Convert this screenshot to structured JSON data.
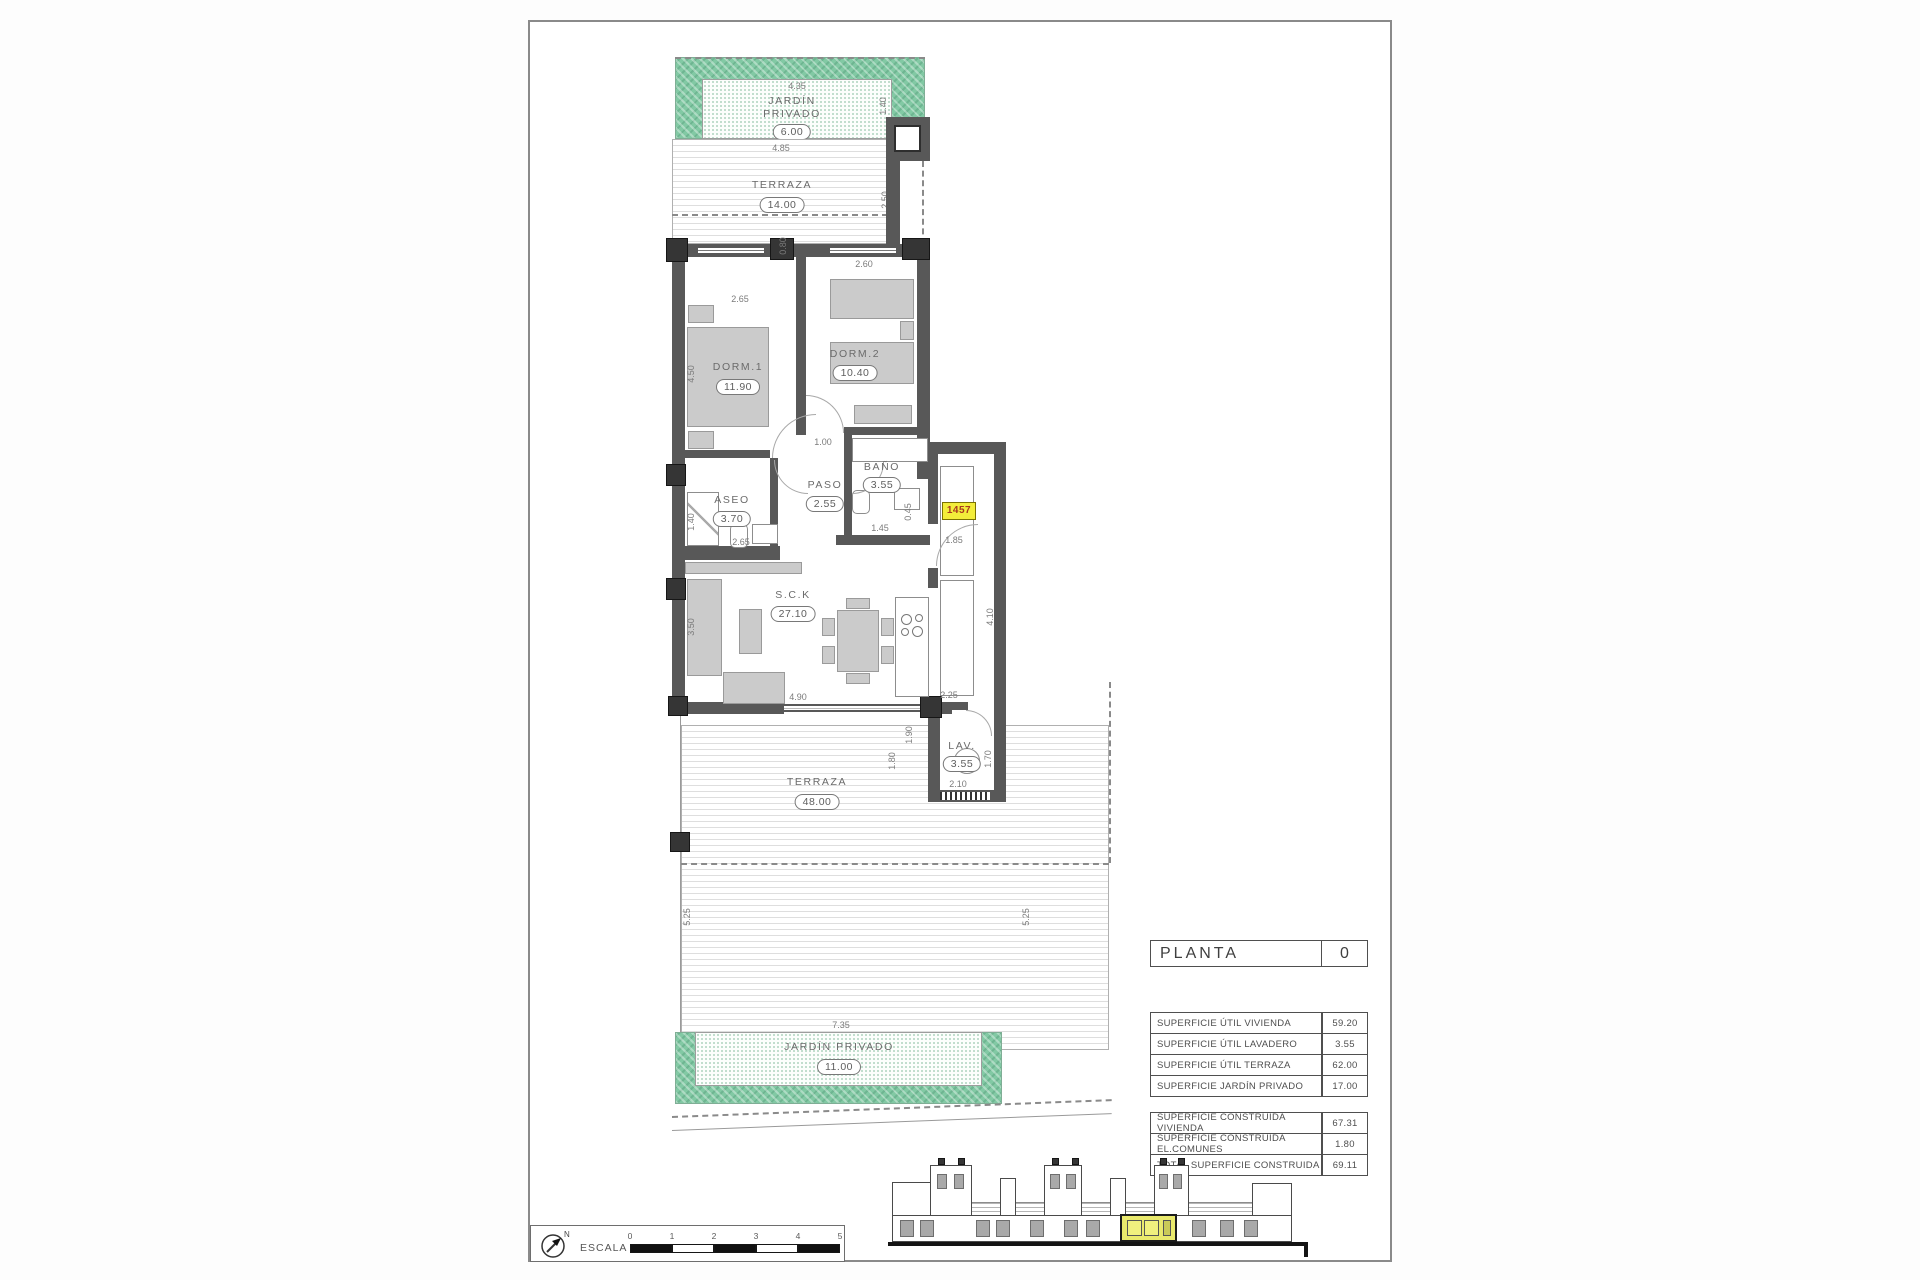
{
  "page": {
    "planta": {
      "label": "PLANTA",
      "value": "0"
    },
    "tables": {
      "util": [
        {
          "label": "SUPERFICIE ÚTIL VIVIENDA",
          "value": "59.20"
        },
        {
          "label": "SUPERFICIE ÚTIL LAVADERO",
          "value": "3.55"
        },
        {
          "label": "SUPERFICIE ÚTIL TERRAZA",
          "value": "62.00"
        },
        {
          "label": "SUPERFICIE JARDÍN PRIVADO",
          "value": "17.00"
        }
      ],
      "construida": [
        {
          "label": "SUPERFICIE CONSTRUIDA VIVIENDA",
          "value": "67.31"
        },
        {
          "label": "SUPERFICIE CONSTRUIDA EL.COMUNES",
          "value": "1.80"
        },
        {
          "label": "TOTAL SUPERFICIE CONSTRUIDA",
          "value": "69.11"
        }
      ]
    },
    "rooms": {
      "jardin_top": {
        "line1": "JARDÍN",
        "line2": "PRIVADO",
        "area": "6.00"
      },
      "terraza_top": {
        "name": "TERRAZA",
        "area": "14.00"
      },
      "dorm1": {
        "name": "DORM.1",
        "area": "11.90"
      },
      "dorm2": {
        "name": "DORM.2",
        "area": "10.40"
      },
      "aseo": {
        "name": "ASEO",
        "area": "3.70"
      },
      "paso": {
        "name": "PASO",
        "area": "2.55"
      },
      "bano": {
        "name": "BAÑO",
        "area": "3.55"
      },
      "sck": {
        "name": "S.C.K",
        "area": "27.10"
      },
      "lav": {
        "name": "LAV.",
        "area": "3.55"
      },
      "terraza_bottom": {
        "name": "TERRAZA",
        "area": "48.00"
      },
      "jardin_bottom": {
        "name": "JARDÍN PRIVADO",
        "area": "11.00"
      }
    },
    "unit_tag": "1457",
    "dims": {
      "d435": "4.35",
      "d140": "1.40",
      "d485": "4.85",
      "d250": "2.50",
      "d080": "0.80",
      "d260": "2.60",
      "d265a": "2.65",
      "d450": "4.50",
      "d100": "1.00",
      "d140b": "1.40",
      "d265b": "2.65",
      "d045": "0.45",
      "d145": "1.45",
      "d185": "1.85",
      "d350": "3.50",
      "d490": "4.90",
      "d410": "4.10",
      "d225": "2.25",
      "d180": "1.80",
      "d190": "1.90",
      "d170": "1.70",
      "d210": "2.10",
      "d525l": "5.25",
      "d525r": "5.25",
      "d735": "7.35"
    },
    "scale": {
      "label": "ESCALA :",
      "ticks": [
        "0",
        "1",
        "2",
        "3",
        "4",
        "5"
      ],
      "north": "N"
    }
  }
}
